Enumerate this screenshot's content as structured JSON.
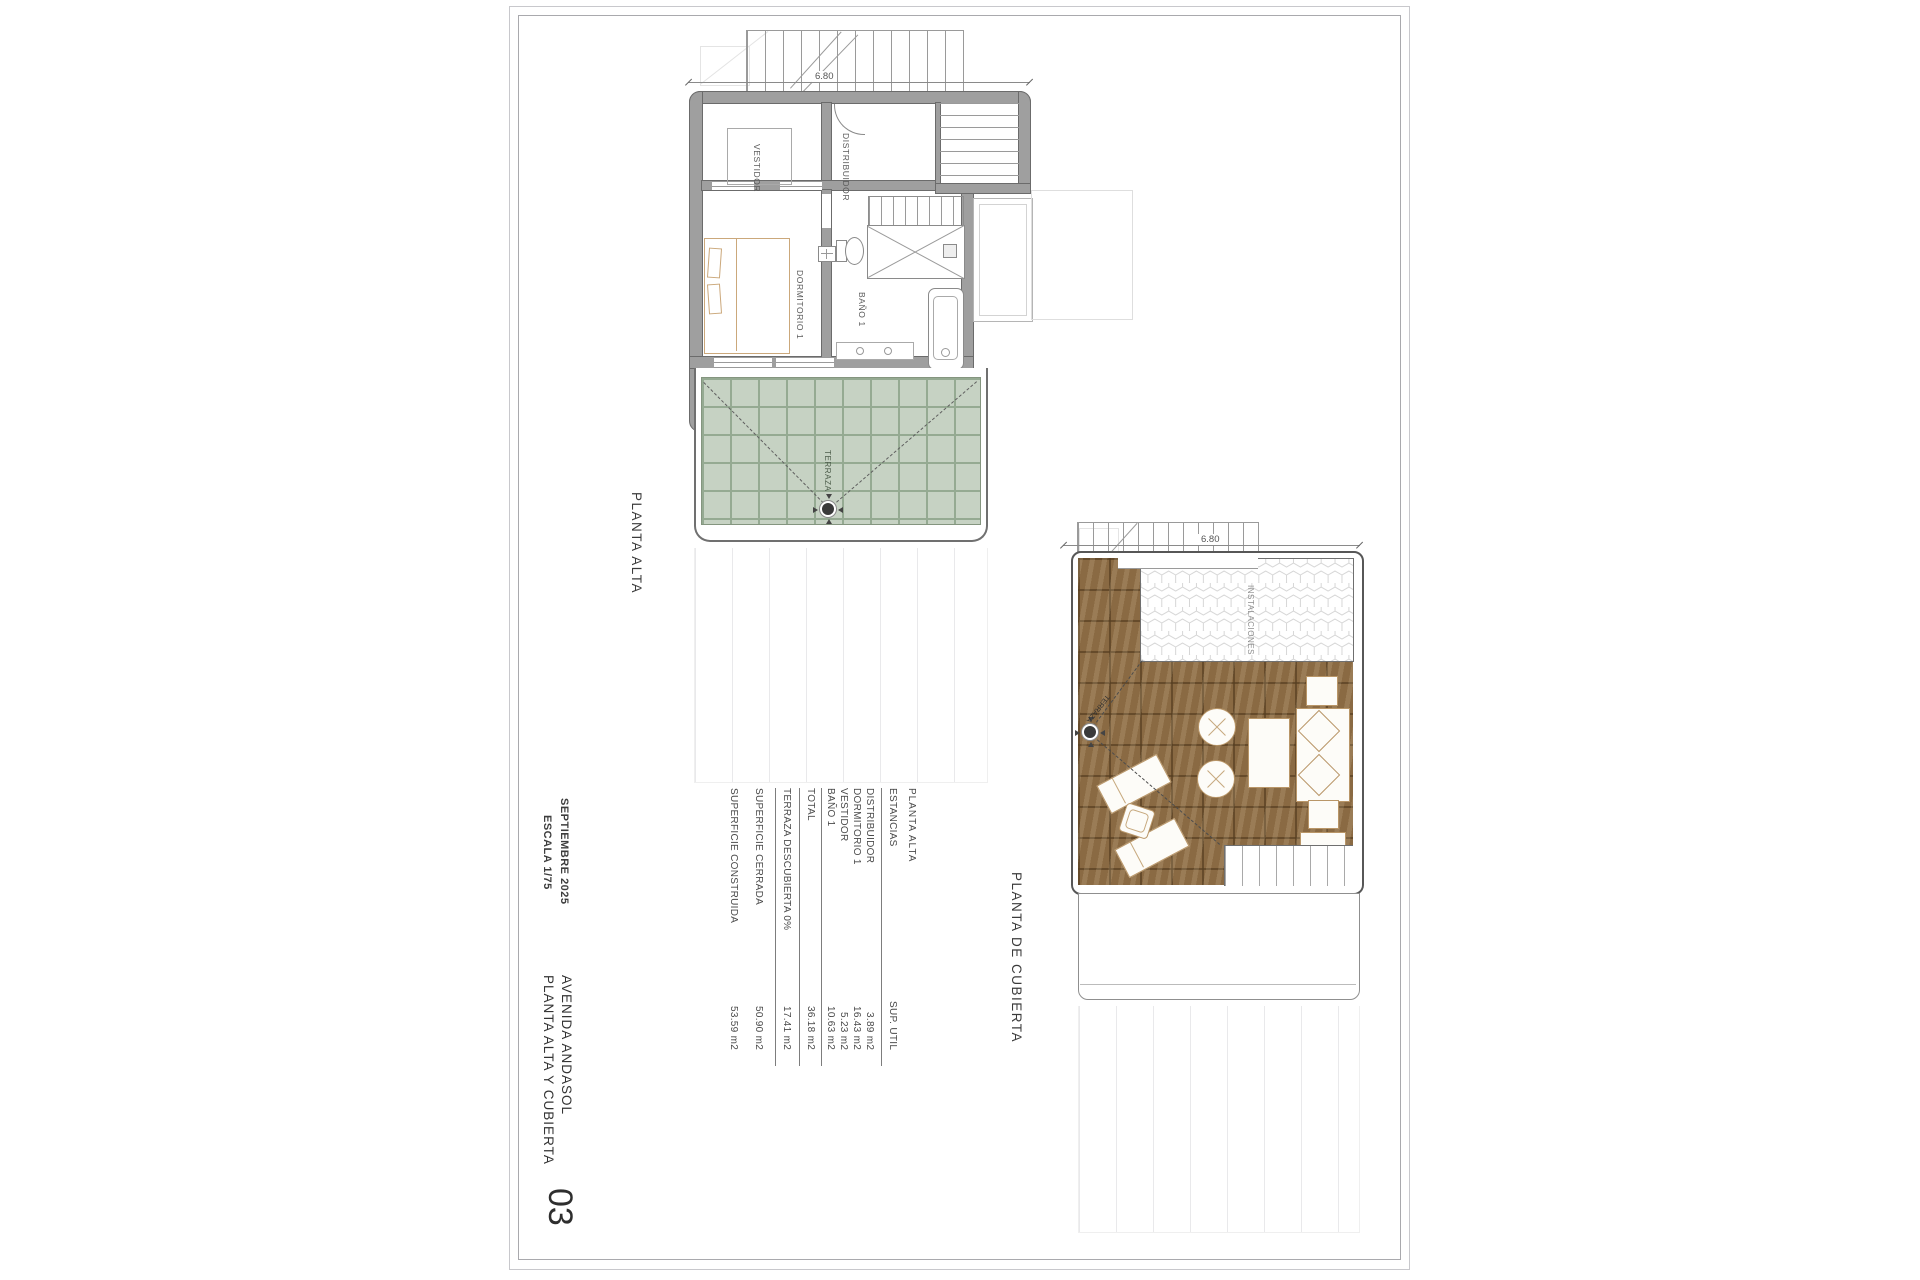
{
  "sheet": {
    "number": "03",
    "project": "AVENIDA ANDASOL",
    "title": "PLANTA ALTA Y CUBIERTA",
    "date": "SEPTIEMBRE 2025",
    "scale": "ESCALA 1/75"
  },
  "plan_alta": {
    "title": "PLANTA ALTA",
    "dim": "6.80",
    "rooms": {
      "vestidor": "VESTIDOR",
      "distribuidor": "DISTRIBUIDOR",
      "dormitorio": "DORMITORIO 1",
      "bano": "BAÑO 1",
      "terraza": "TERRAZA"
    }
  },
  "plan_cubierta": {
    "title": "PLANTA DE CUBIERTA",
    "dim": "6.80",
    "rooms": {
      "instalaciones": "INSTALACIONES",
      "terraza": "TERRAZA"
    }
  },
  "area_table": {
    "header": "PLANTA ALTA",
    "col_room": "ESTANCIAS",
    "col_area": "SUP. UTIL",
    "rows": [
      {
        "label": "DISTRIBUIDOR",
        "value": "3.89 m2"
      },
      {
        "label": "DORMITORIO 1",
        "value": "16.43 m2"
      },
      {
        "label": "VESTIDOR",
        "value": "5.23 m2"
      },
      {
        "label": "BAÑO 1",
        "value": "10.63 m2"
      }
    ],
    "total": {
      "label": "TOTAL",
      "value": "36.18 m2"
    },
    "extras": [
      {
        "label": "TERRAZA DESCUBIERTA 0%",
        "value": "17.41 m2"
      },
      {
        "label": "SUPERFICIE CERRADA",
        "value": "50.90 m2"
      },
      {
        "label": "SUPERFICIE CONSTRUIDA",
        "value": "53.59 m2"
      }
    ]
  },
  "colors": {
    "wall": "#9f9f9f",
    "terrace_tile": "#c6d2c3",
    "wood_deck": "#8a6a43",
    "furniture_outline": "#b99668",
    "line": "#555555"
  }
}
